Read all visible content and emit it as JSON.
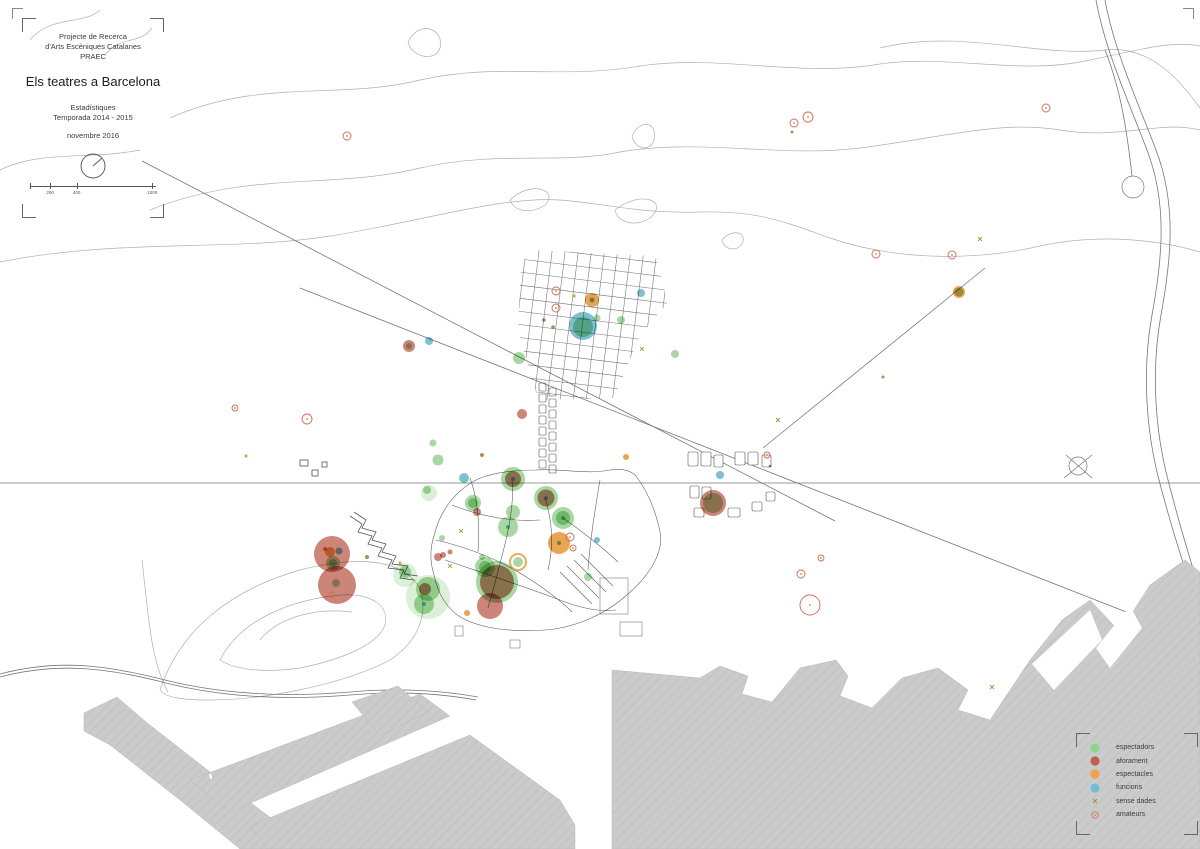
{
  "title_block": {
    "line1": "Projecte de Recerca",
    "line2": "d'Arts Escèniques Catalanes",
    "line3": "PRAEC",
    "title": "Els teatres a Barcelona",
    "sub1": "Estadístiques",
    "sub2": "Temporada 2014 - 2015",
    "date": "novembre 2016",
    "scale_ticks": [
      "200",
      "400",
      "1000"
    ]
  },
  "legend": {
    "items": [
      {
        "label": "espectadors",
        "type": "espectadors",
        "swatch": "#8fd48a"
      },
      {
        "label": "aforament",
        "type": "aforament",
        "swatch": "#bd6052"
      },
      {
        "label": "espectacles",
        "type": "espectacles",
        "swatch": "#eca24e"
      },
      {
        "label": "funcions",
        "type": "funcions",
        "swatch": "#74bcd2"
      },
      {
        "label": "sense dades",
        "type": "sense",
        "swatch": "#9a9a35"
      },
      {
        "label": "amateurs",
        "type": "amateurs",
        "swatch": "#d06a58"
      }
    ]
  },
  "styles": {
    "espectadors": {
      "fill": "#a8d8a2"
    },
    "espectadors_light": {
      "fill": "#dcefd8"
    },
    "aforament": {
      "fill": "#cc8578"
    },
    "espectacles": {
      "fill": "#eaa452"
    },
    "funcions": {
      "fill": "#7cc0d2"
    },
    "espectacles_ring": {
      "stroke": "#e2902f"
    },
    "amateurs": {
      "stroke": "#d06a58"
    },
    "sense": {
      "stroke": "#9a9a35"
    },
    "sense_dot": {
      "fill": "#a5763a"
    }
  },
  "map_points": [
    {
      "x": 347,
      "y": 136,
      "r": 4,
      "t": "amateurs"
    },
    {
      "x": 794,
      "y": 123,
      "r": 4,
      "t": "amateurs"
    },
    {
      "x": 808,
      "y": 117,
      "r": 5,
      "t": "amateurs"
    },
    {
      "x": 792,
      "y": 132,
      "r": 1.5,
      "t": "sense_dot"
    },
    {
      "x": 876,
      "y": 254,
      "r": 4,
      "t": "amateurs"
    },
    {
      "x": 952,
      "y": 255,
      "r": 4,
      "t": "amateurs"
    },
    {
      "x": 980,
      "y": 239,
      "r": 2,
      "t": "sense"
    },
    {
      "x": 959,
      "y": 292,
      "r": 6,
      "t": "espectacles"
    },
    {
      "x": 959,
      "y": 292,
      "r": 4.5,
      "t": "espectadors"
    },
    {
      "x": 1046,
      "y": 108,
      "r": 4,
      "t": "amateurs"
    },
    {
      "x": 883,
      "y": 377,
      "r": 1.5,
      "t": "sense_dot"
    },
    {
      "x": 556,
      "y": 291,
      "r": 4,
      "t": "amateurs"
    },
    {
      "x": 556,
      "y": 308,
      "r": 4,
      "t": "amateurs"
    },
    {
      "x": 592,
      "y": 300,
      "r": 7,
      "t": "espectacles"
    },
    {
      "x": 592,
      "y": 300,
      "r": 2.5,
      "t": "funcions"
    },
    {
      "x": 574,
      "y": 296,
      "r": 1.5,
      "t": "sense"
    },
    {
      "x": 583,
      "y": 326,
      "r": 14,
      "t": "funcions"
    },
    {
      "x": 583,
      "y": 327,
      "r": 10,
      "t": "espectadors"
    },
    {
      "x": 597,
      "y": 318,
      "r": 3.5,
      "t": "espectadors"
    },
    {
      "x": 544,
      "y": 320,
      "r": 1.8,
      "t": "sense_dot"
    },
    {
      "x": 553,
      "y": 327,
      "r": 1.8,
      "t": "sense_dot"
    },
    {
      "x": 519,
      "y": 358,
      "r": 6,
      "t": "espectadors"
    },
    {
      "x": 641,
      "y": 293,
      "r": 4,
      "t": "funcions"
    },
    {
      "x": 621,
      "y": 320,
      "r": 4,
      "t": "espectadors"
    },
    {
      "x": 642,
      "y": 349,
      "r": 1.8,
      "t": "sense"
    },
    {
      "x": 675,
      "y": 354,
      "r": 4,
      "t": "espectadors"
    },
    {
      "x": 409,
      "y": 346,
      "r": 6,
      "t": "aforament"
    },
    {
      "x": 409,
      "y": 346,
      "r": 3,
      "t": "espectadors"
    },
    {
      "x": 429,
      "y": 341,
      "r": 4,
      "t": "funcions"
    },
    {
      "x": 235,
      "y": 408,
      "r": 3,
      "t": "amateurs"
    },
    {
      "x": 307,
      "y": 419,
      "r": 5,
      "t": "amateurs"
    },
    {
      "x": 246,
      "y": 456,
      "r": 1.4,
      "t": "sense"
    },
    {
      "x": 433,
      "y": 443,
      "r": 3.5,
      "t": "espectadors"
    },
    {
      "x": 438,
      "y": 460,
      "r": 5.5,
      "t": "espectadors"
    },
    {
      "x": 482,
      "y": 455,
      "r": 2,
      "t": "sense_dot"
    },
    {
      "x": 522,
      "y": 414,
      "r": 5,
      "t": "aforament"
    },
    {
      "x": 626,
      "y": 457,
      "r": 3,
      "t": "espectacles"
    },
    {
      "x": 513,
      "y": 479,
      "r": 12,
      "t": "espectadors"
    },
    {
      "x": 513,
      "y": 479,
      "r": 8,
      "t": "aforament"
    },
    {
      "x": 513,
      "y": 479,
      "r": 2,
      "t": "funcions"
    },
    {
      "x": 546,
      "y": 498,
      "r": 12,
      "t": "espectadors"
    },
    {
      "x": 546,
      "y": 498,
      "r": 8.5,
      "t": "aforament"
    },
    {
      "x": 546,
      "y": 498,
      "r": 2,
      "t": "funcions"
    },
    {
      "x": 563,
      "y": 518,
      "r": 11,
      "t": "espectadors"
    },
    {
      "x": 563,
      "y": 518,
      "r": 7,
      "t": "espectadors"
    },
    {
      "x": 563,
      "y": 518,
      "r": 2,
      "t": "funcions"
    },
    {
      "x": 513,
      "y": 512,
      "r": 7,
      "t": "espectadors"
    },
    {
      "x": 508,
      "y": 527,
      "r": 10,
      "t": "espectadors"
    },
    {
      "x": 508,
      "y": 527,
      "r": 2,
      "t": "funcions"
    },
    {
      "x": 464,
      "y": 478,
      "r": 5,
      "t": "funcions"
    },
    {
      "x": 473,
      "y": 503,
      "r": 8,
      "t": "espectadors"
    },
    {
      "x": 473,
      "y": 503,
      "r": 5,
      "t": "espectadors"
    },
    {
      "x": 477,
      "y": 512,
      "r": 4,
      "t": "aforament"
    },
    {
      "x": 461,
      "y": 531,
      "r": 1.8,
      "t": "sense"
    },
    {
      "x": 429,
      "y": 493,
      "r": 8,
      "t": "espectadors_light"
    },
    {
      "x": 427,
      "y": 490,
      "r": 4,
      "t": "espectadors"
    },
    {
      "x": 559,
      "y": 543,
      "r": 11,
      "t": "espectacles"
    },
    {
      "x": 559,
      "y": 543,
      "r": 2,
      "t": "funcions"
    },
    {
      "x": 570,
      "y": 537,
      "r": 4,
      "t": "amateurs"
    },
    {
      "x": 573,
      "y": 548,
      "r": 3,
      "t": "amateurs"
    },
    {
      "x": 597,
      "y": 540,
      "r": 3,
      "t": "funcions"
    },
    {
      "x": 588,
      "y": 577,
      "r": 4,
      "t": "espectadors"
    },
    {
      "x": 482,
      "y": 557,
      "r": 3,
      "t": "espectadors"
    },
    {
      "x": 518,
      "y": 562,
      "r": 8,
      "t": "espectacles_ring"
    },
    {
      "x": 518,
      "y": 562,
      "r": 5,
      "t": "espectadors"
    },
    {
      "x": 442,
      "y": 538,
      "r": 3,
      "t": "espectadors"
    },
    {
      "x": 443,
      "y": 555,
      "r": 3,
      "t": "aforament"
    },
    {
      "x": 438,
      "y": 557,
      "r": 4,
      "t": "aforament"
    },
    {
      "x": 450,
      "y": 552,
      "r": 2.5,
      "t": "aforament"
    },
    {
      "x": 450,
      "y": 566,
      "r": 1.8,
      "t": "sense"
    },
    {
      "x": 485,
      "y": 567,
      "r": 10,
      "t": "espectadors"
    },
    {
      "x": 485,
      "y": 567,
      "r": 6,
      "t": "espectadors"
    },
    {
      "x": 497,
      "y": 582,
      "r": 21,
      "t": "espectadors"
    },
    {
      "x": 497,
      "y": 582,
      "r": 17,
      "t": "aforament"
    },
    {
      "x": 490,
      "y": 606,
      "r": 13,
      "t": "aforament"
    },
    {
      "x": 467,
      "y": 613,
      "r": 3,
      "t": "espectacles"
    },
    {
      "x": 428,
      "y": 597,
      "r": 22,
      "t": "espectadors_light"
    },
    {
      "x": 428,
      "y": 589,
      "r": 12,
      "t": "espectadors"
    },
    {
      "x": 425,
      "y": 589,
      "r": 6,
      "t": "aforament"
    },
    {
      "x": 424,
      "y": 604,
      "r": 10,
      "t": "espectadors"
    },
    {
      "x": 424,
      "y": 604,
      "r": 2,
      "t": "funcions"
    },
    {
      "x": 405,
      "y": 575,
      "r": 12,
      "t": "espectadors_light"
    },
    {
      "x": 405,
      "y": 572,
      "r": 6,
      "t": "espectadors"
    },
    {
      "x": 400,
      "y": 563,
      "r": 1.4,
      "t": "sense"
    },
    {
      "x": 332,
      "y": 554,
      "r": 18,
      "t": "aforament"
    },
    {
      "x": 337,
      "y": 585,
      "r": 19,
      "t": "aforament"
    },
    {
      "x": 330,
      "y": 552,
      "r": 5,
      "t": "espectacles"
    },
    {
      "x": 333,
      "y": 563,
      "r": 7,
      "t": "espectadors"
    },
    {
      "x": 333,
      "y": 563,
      "r": 4,
      "t": "espectadors"
    },
    {
      "x": 339,
      "y": 551,
      "r": 3.5,
      "t": "funcions"
    },
    {
      "x": 325,
      "y": 549,
      "r": 2,
      "t": "aforament"
    },
    {
      "x": 336,
      "y": 583,
      "r": 4,
      "t": "espectadors"
    },
    {
      "x": 332,
      "y": 595,
      "r": 3,
      "t": "amateurs"
    },
    {
      "x": 367,
      "y": 557,
      "r": 2,
      "t": "sense_dot"
    },
    {
      "x": 713,
      "y": 503,
      "r": 13,
      "t": "aforament"
    },
    {
      "x": 713,
      "y": 503,
      "r": 10,
      "t": "espectadors"
    },
    {
      "x": 720,
      "y": 475,
      "r": 4,
      "t": "funcions"
    },
    {
      "x": 767,
      "y": 455,
      "r": 3,
      "t": "amateurs"
    },
    {
      "x": 778,
      "y": 420,
      "r": 2,
      "t": "sense"
    },
    {
      "x": 770,
      "y": 466,
      "r": 1.4,
      "t": "sense_dot"
    },
    {
      "x": 821,
      "y": 558,
      "r": 3,
      "t": "amateurs"
    },
    {
      "x": 801,
      "y": 574,
      "r": 4,
      "t": "amateurs"
    },
    {
      "x": 810,
      "y": 605,
      "r": 10,
      "t": "amateurs"
    },
    {
      "x": 992,
      "y": 687,
      "r": 2,
      "t": "sense"
    }
  ]
}
